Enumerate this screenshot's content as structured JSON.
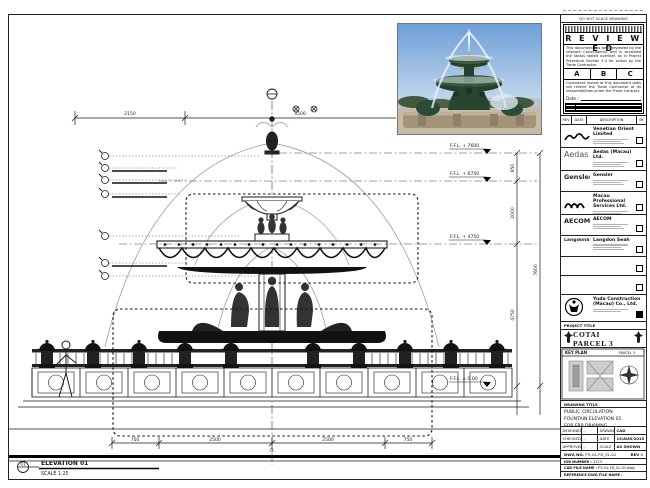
{
  "sidebar": {
    "note": "DO NOT SCALE DRAWING",
    "stamp": {
      "title": "R E V I E W E D",
      "para1": "This document has been reviewed by the relevant Consultant(s) and is accorded the Status stated overleaf, as in Project Procedure Section 5.4 for action by the Trade Contractor.",
      "statuses": [
        "A",
        "B",
        "C"
      ],
      "para2": "Consultant review of this document does not relieve the Trade Contractor of its responsibilities under the Trade Contract.",
      "date_label": "Date :"
    },
    "revision_bar": {
      "rev": "REV",
      "date": "DATE",
      "desc": "DESCRIPTION",
      "by": "BY"
    },
    "companies": [
      {
        "logo_text": "",
        "name": "Venetian Orient Limited"
      },
      {
        "logo_text": "Aedas",
        "name": "Aedas (Macau) Ltd."
      },
      {
        "logo_text": "Gensler",
        "name": "Gensler"
      },
      {
        "logo_text": "",
        "name": "Macau Professional Services Ltd."
      },
      {
        "logo_text": "AECOM",
        "name": "AECOM"
      },
      {
        "logo_text": "LangdonSeah",
        "name": "Langdon Seah"
      },
      {
        "logo_text": "",
        "name": ""
      },
      {
        "logo_text": "",
        "name": ""
      },
      {
        "logo_text": "",
        "name": "Yuda Construction (Macau) Co., Ltd."
      }
    ],
    "project": {
      "label": "PROJECT TITLE",
      "title": "COTAI PARCEL 3"
    },
    "key_plan": {
      "label": "KEY PLAN",
      "parcel": "PARCEL 3"
    },
    "title_block": {
      "drawing_title_label": "DRAWING TITLE",
      "line1": "PUBLIC CIRCULATION",
      "line2": "FOUNTAIN ELEVATION 01",
      "line3": "FOR FRP DRAWING",
      "rows": [
        {
          "l": "DESIGNED",
          "v": "-",
          "l2": "DRAWN",
          "v2": "CAD"
        },
        {
          "l": "CHECKED",
          "v": "-",
          "l2": "DATE",
          "v2": "13/AUG/2015"
        },
        {
          "l": "APPROVED",
          "v": "-",
          "l2": "SCALE",
          "v2": "AS SHOWN"
        }
      ],
      "dwg_no_label": "DWG NO.",
      "dwg_no": "P3-GL-FD_EL-01",
      "rev_label": "REV",
      "rev": "0",
      "job_label": "JOB NUMBER :",
      "job": "3123",
      "cad_label": "CAD FILE NAME :",
      "cad": "P3-GL-FD_EL-01.dwg",
      "ref_label": "REFERENCE DWG FILE NAME :"
    }
  },
  "drawing": {
    "view_title": "ELEVATION 01",
    "view_scale": "SCALE 1:25",
    "view_bubble": "01",
    "levels": [
      "F.F.L. + 7600",
      "F.F.L. + 6750",
      "F.F.L. + 4750",
      "F.F.L. ± 0.00"
    ],
    "dims": {
      "top_left": "2150",
      "top_mid": "4500",
      "top_right": "2150",
      "right_1": "850",
      "right_2": "2000",
      "right_3": "4750",
      "right_total": "7600",
      "bot_1": "750",
      "bot_2": "2500",
      "bot_3": "2500",
      "bot_4": "750",
      "centerline": "CL"
    },
    "colors": {
      "line": "#1a1a1a",
      "water": "#a8a8a8",
      "fill_dark": "#111111"
    }
  }
}
